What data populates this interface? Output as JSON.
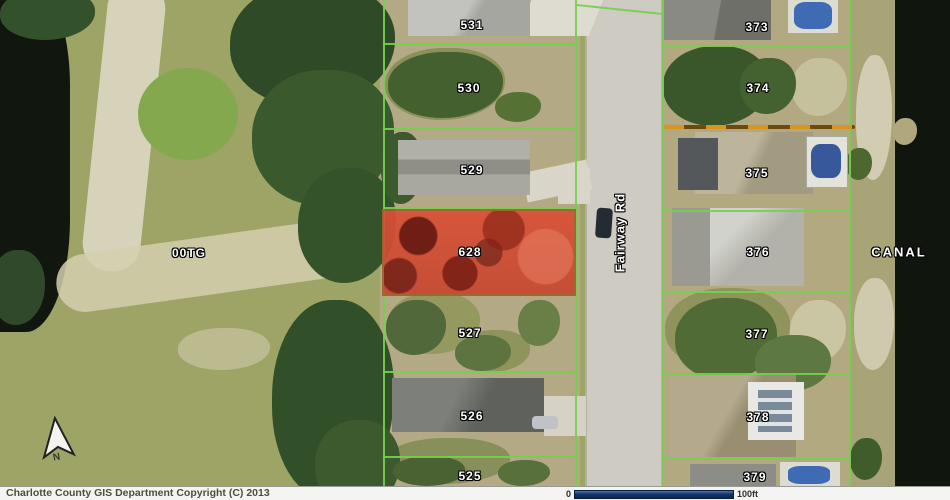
{
  "map": {
    "parcels_left": [
      "531",
      "530",
      "529",
      "628",
      "527",
      "526",
      "525"
    ],
    "parcels_right": [
      "373",
      "374",
      "375",
      "376",
      "377",
      "378",
      "379"
    ],
    "highlighted_parcel": "628",
    "road_label": "Fairway Rd",
    "area_labels": {
      "golf_course": "00TG",
      "canal": "CANAL"
    },
    "north_label": "N"
  },
  "scalebar": {
    "start": "0",
    "end": "100ft"
  },
  "footer": {
    "copyright": "Charlotte County GIS Department Copyright (C) 2013"
  },
  "colors": {
    "parcel_line_green": "#76cf50",
    "highlight_fill": "#da5038",
    "highlight_border": "#a4602c",
    "boundary_orange": "#d8941f",
    "scalebar_blue": "#16356e",
    "water_dark": "#10150e",
    "road_gray": "#cdcbc2"
  }
}
